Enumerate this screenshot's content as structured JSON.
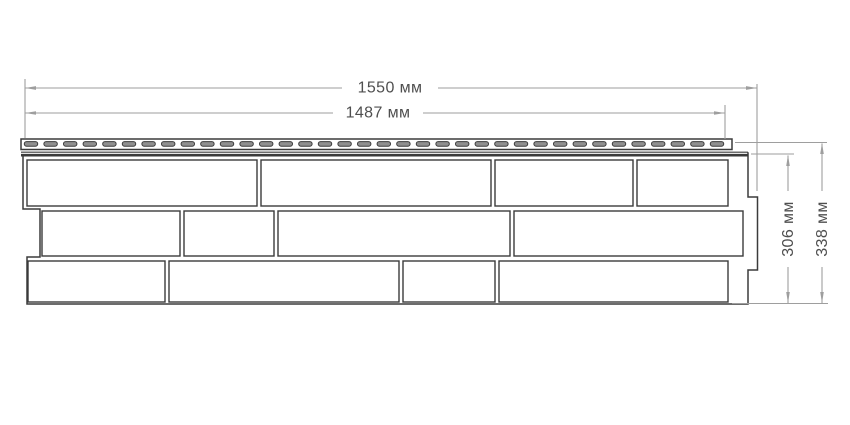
{
  "dimensions": {
    "width_total": "1550 мм",
    "width_working": "1487 мм",
    "height_working": "306 мм",
    "height_total": "338 мм"
  },
  "panel": {
    "nail_strip": {
      "slot_count": 36
    },
    "brick_rows": 3,
    "bricks_per_row": 4
  },
  "colors": {
    "outline": "#3b3b3b",
    "slot_fill": "#8f8f8f",
    "dimension_line": "#9e9e9e",
    "text": "#4f4f4f",
    "background": "#ffffff"
  }
}
